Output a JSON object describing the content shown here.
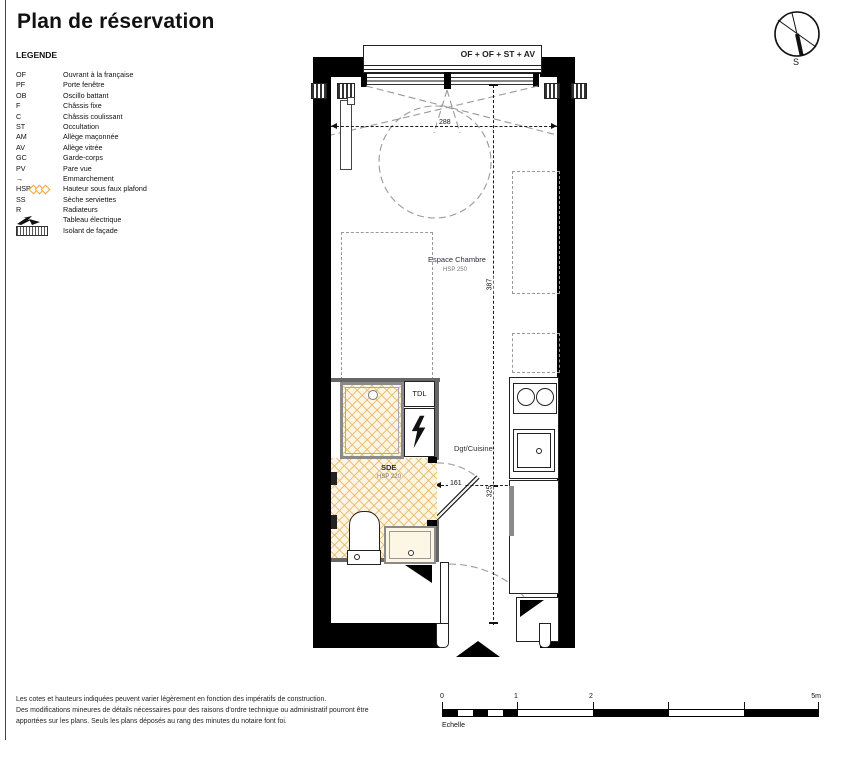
{
  "title": "Plan de réservation",
  "legend": {
    "heading": "LEGENDE",
    "items": [
      {
        "key": "OF",
        "label": "Ouvrant à la française"
      },
      {
        "key": "PF",
        "label": "Porte fenêtre"
      },
      {
        "key": "OB",
        "label": "Oscillo battant"
      },
      {
        "key": "F",
        "label": "Châssis fixe"
      },
      {
        "key": "C",
        "label": "Châssis coulissant"
      },
      {
        "key": "ST",
        "label": "Occultation"
      },
      {
        "key": "AM",
        "label": "Allège maçonnée"
      },
      {
        "key": "AV",
        "label": "Allège vitrée"
      },
      {
        "key": "GC",
        "label": "Garde-corps"
      },
      {
        "key": "PV",
        "label": "Pare vue"
      },
      {
        "key": "→",
        "label": "Emmarchement"
      },
      {
        "key": "HSP",
        "label": "Hauteur sous faux plafond"
      },
      {
        "key": "SS",
        "label": "Sèche serviettes"
      },
      {
        "key": "R",
        "label": "Radiateurs"
      },
      {
        "key": "",
        "label": "Tableau électrique"
      },
      {
        "key": "",
        "label": "Isolant de façade"
      }
    ]
  },
  "compass": {
    "south": "S"
  },
  "plan": {
    "window_label": "OF + OF + ST + AV",
    "labels": {
      "chambre": "Espace Chambre",
      "chambre_hsp": "HSP 250",
      "sde": "SDE",
      "sde_hsp": "HSP 220",
      "dgt": "Dgt/Cuisine",
      "tdl": "TDL"
    },
    "dims": {
      "d288": "288",
      "d387": "387",
      "d325": "325",
      "d161": "161",
      "d120": "120",
      "d237": "237"
    }
  },
  "notes": [
    "Les cotes et hauteurs indiquées peuvent varier légèrement en fonction des impératifs de construction.",
    "Des modifications mineures de détails nécessaires pour des raisons d'ordre technique ou administratif pourront être",
    "apportées sur les plans. Seuls les plans déposés au rang des minutes du notaire font foi."
  ],
  "scalebar": {
    "label": "Echelle",
    "tick0": "0",
    "tick1": "1",
    "tick2": "2",
    "tick5": "5m"
  },
  "colors": {
    "wall": "#000000",
    "hatch": "#e9b96b",
    "dash_gray": "#9a9a9a",
    "hsp_accent": "#f0a63c"
  }
}
